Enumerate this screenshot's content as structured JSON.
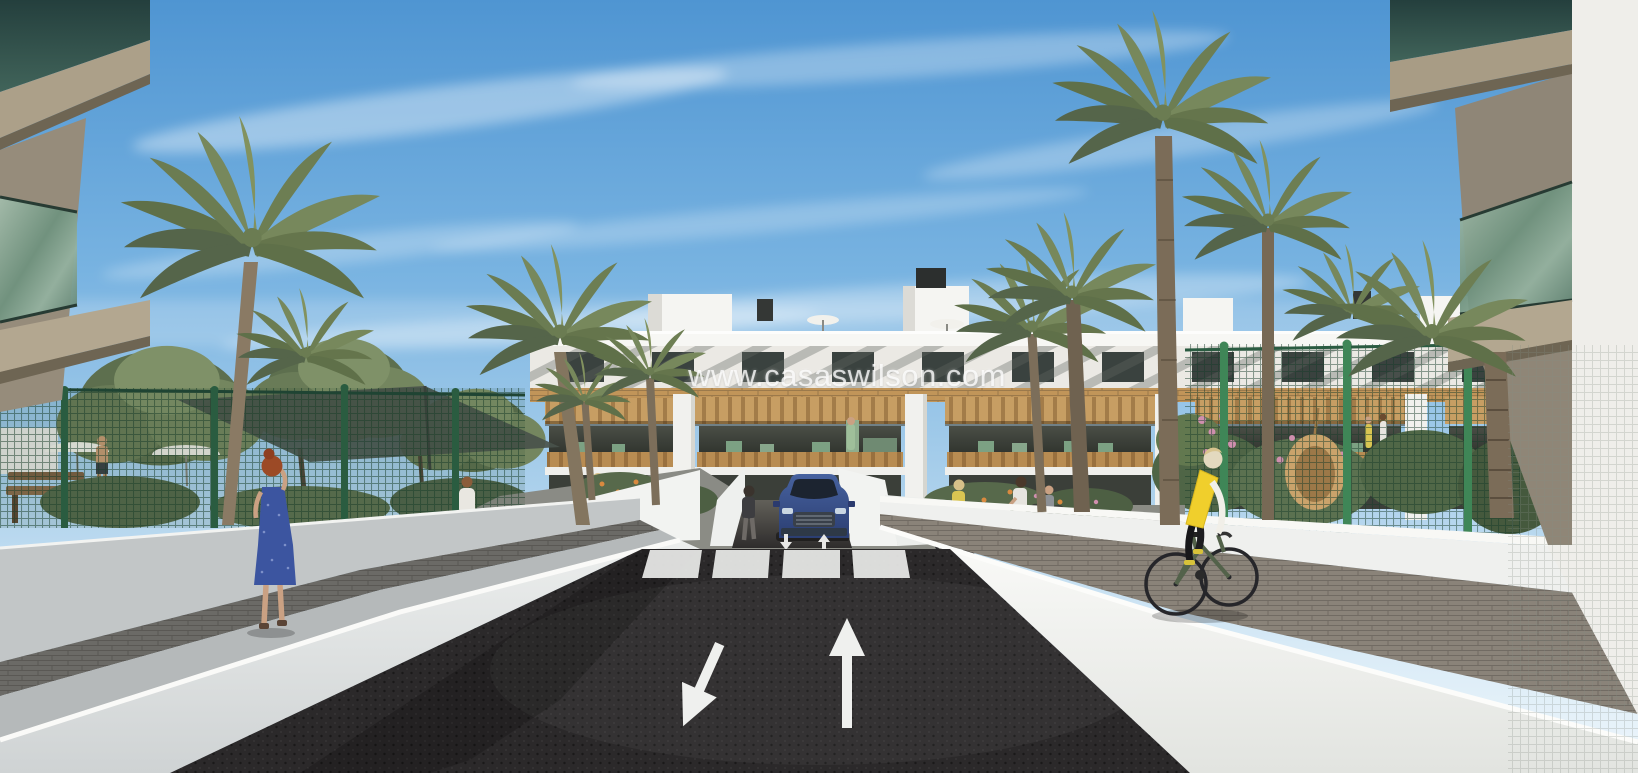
{
  "watermark": {
    "text": "www.casaswilson.com"
  },
  "scene": {
    "alt": "3D architectural rendering of a modern white apartment complex with wood-clad balconies among palm trees; sunken access road with underground parking ramp, blue SUV, zebra crosswalk, directional arrows, pedestrians and a cyclist",
    "entities": [
      "woman in blue dress talking on phone",
      "cyclist in yellow vest",
      "pedestrians on garden paths",
      "blue SUV at parking ramp",
      "palm trees",
      "green mesh fences",
      "white perimeter walls"
    ]
  },
  "road_markings": {
    "left_arrow": "arrow-down-left",
    "right_arrow": "arrow-up",
    "ramp_arrows": [
      "arrow-down",
      "arrow-up"
    ],
    "crosswalk_bars": 4
  },
  "palette": {
    "sky_top": "#4f95d2",
    "sky_horizon": "#eef6fb",
    "asphalt": "#2b292a",
    "wall_sunlit": "#f3f4f2",
    "wall_shaded": "#c2c6c7",
    "wood": "#c19559",
    "palm_frond": "#77885c",
    "fence_green": "#2f6247",
    "post_green": "#3f8657",
    "suv_blue": "#3c549a",
    "vest_yellow": "#f0cf2c",
    "dress_blue": "#3c55a0",
    "top_pink": "#c94f78"
  }
}
